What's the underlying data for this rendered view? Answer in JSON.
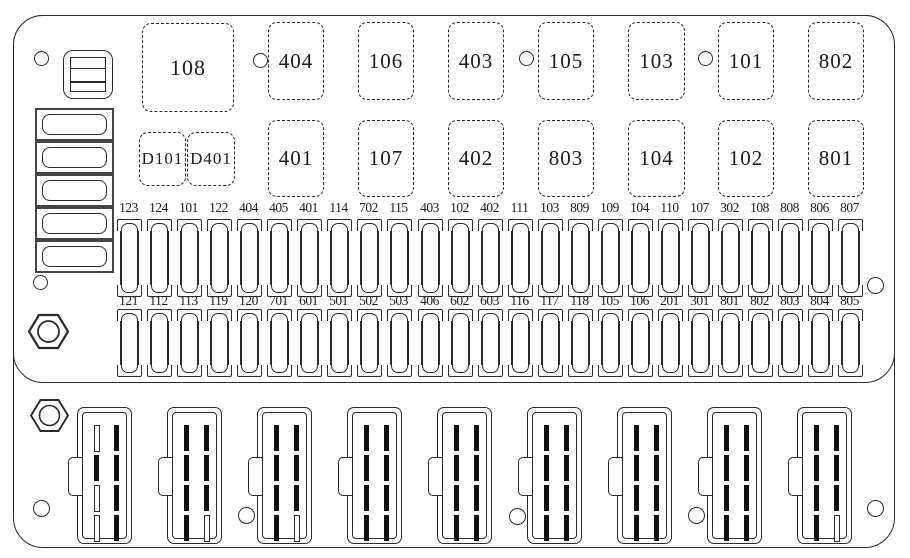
{
  "colors": {
    "line": "#2b2b2b",
    "slot_fill": "#101010",
    "background": "#ffffff"
  },
  "relay_boxes": [
    {
      "label": "108",
      "x": 142,
      "y": 23,
      "w": 90,
      "h": 87,
      "fs": 22
    },
    {
      "label": "404",
      "x": 268,
      "y": 22,
      "w": 54,
      "h": 76
    },
    {
      "label": "106",
      "x": 358,
      "y": 22,
      "w": 54,
      "h": 76
    },
    {
      "label": "403",
      "x": 448,
      "y": 22,
      "w": 54,
      "h": 76
    },
    {
      "label": "105",
      "x": 538,
      "y": 22,
      "w": 54,
      "h": 76
    },
    {
      "label": "103",
      "x": 628,
      "y": 22,
      "w": 55,
      "h": 76
    },
    {
      "label": "101",
      "x": 718,
      "y": 22,
      "w": 54,
      "h": 76
    },
    {
      "label": "802",
      "x": 808,
      "y": 22,
      "w": 54,
      "h": 76
    },
    {
      "label": "D101",
      "x": 139,
      "y": 132,
      "w": 45,
      "h": 52,
      "fs": 17
    },
    {
      "label": "D401",
      "x": 187,
      "y": 132,
      "w": 46,
      "h": 52,
      "fs": 17
    },
    {
      "label": "401",
      "x": 268,
      "y": 120,
      "w": 54,
      "h": 75
    },
    {
      "label": "107",
      "x": 358,
      "y": 120,
      "w": 54,
      "h": 75
    },
    {
      "label": "402",
      "x": 448,
      "y": 120,
      "w": 54,
      "h": 75
    },
    {
      "label": "803",
      "x": 538,
      "y": 120,
      "w": 54,
      "h": 75
    },
    {
      "label": "104",
      "x": 628,
      "y": 120,
      "w": 55,
      "h": 75
    },
    {
      "label": "102",
      "x": 718,
      "y": 120,
      "w": 54,
      "h": 75
    },
    {
      "label": "801",
      "x": 808,
      "y": 120,
      "w": 54,
      "h": 75
    }
  ],
  "fuse_rows": [
    {
      "labels": [
        "123",
        "124",
        "101",
        "122",
        "404",
        "405",
        "401",
        "114",
        "702",
        "115",
        "403",
        "102",
        "402",
        "111",
        "103",
        "809",
        "109",
        "104",
        "110",
        "107",
        "302",
        "108",
        "808",
        "806",
        "807"
      ]
    },
    {
      "labels": [
        "121",
        "112",
        "113",
        "119",
        "120",
        "701",
        "601",
        "501",
        "502",
        "503",
        "406",
        "602",
        "603",
        "116",
        "117",
        "118",
        "105",
        "106",
        "201",
        "301",
        "801",
        "802",
        "803",
        "804",
        "805"
      ]
    }
  ],
  "connectors": [
    {
      "slots": [
        0,
        1,
        0,
        0,
        1,
        1,
        1,
        1
      ]
    },
    {
      "slots": [
        1,
        1,
        1,
        1,
        1,
        1,
        1,
        0
      ]
    },
    {
      "slots": [
        1,
        1,
        1,
        1,
        1,
        1,
        1,
        0
      ]
    },
    {
      "slots": [
        1,
        1,
        1,
        1,
        1,
        1,
        1,
        1
      ]
    },
    {
      "slots": [
        1,
        1,
        1,
        1,
        1,
        1,
        1,
        1
      ]
    },
    {
      "slots": [
        1,
        1,
        1,
        1,
        1,
        1,
        1,
        1
      ]
    },
    {
      "slots": [
        1,
        1,
        1,
        1,
        1,
        1,
        1,
        1
      ]
    },
    {
      "slots": [
        1,
        1,
        1,
        1,
        1,
        1,
        1,
        1
      ]
    },
    {
      "slots": [
        1,
        1,
        1,
        1,
        1,
        1,
        1,
        0
      ]
    }
  ]
}
